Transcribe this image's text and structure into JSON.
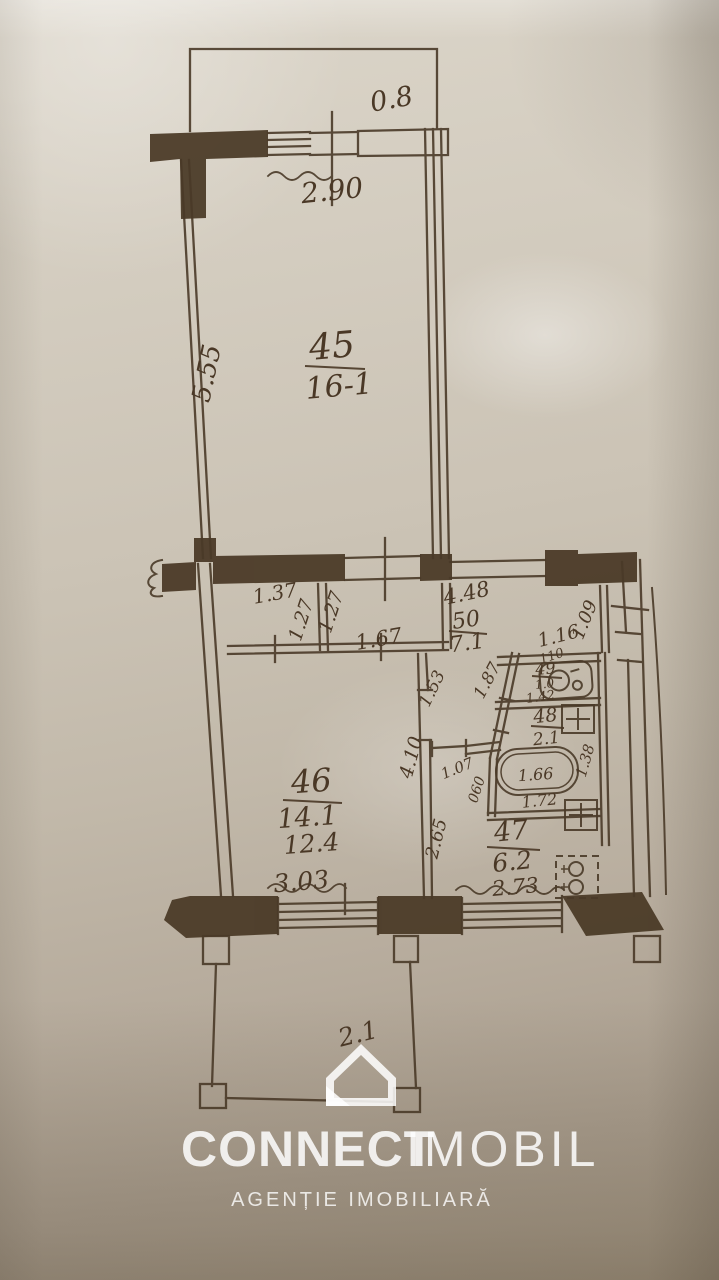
{
  "plan": {
    "rooms": {
      "r45": {
        "number": "45",
        "area": "16-1"
      },
      "r46": {
        "number": "46",
        "area": "14.1",
        "area_alt": "12.4"
      },
      "r47": {
        "number": "47",
        "area": "6.2"
      },
      "r48": {
        "number": "48",
        "area": "2.1"
      },
      "r49": {
        "number": "49",
        "area": "1.0"
      },
      "r50": {
        "number": "50",
        "area": "7.1"
      }
    },
    "dims": {
      "balcony_top_depth": "0.8",
      "window_top": "2.90",
      "room45_depth": "5.55",
      "closet_width": "1.37",
      "closet_depth_1": "1.27",
      "closet_depth_2": "1.27",
      "closet_width_2": "1.67",
      "hall_length": "4.48",
      "right_niche_1": "1.09",
      "right_niche_2": "1.16",
      "wc_width": "110",
      "wc_depth": "1.42",
      "diag_wall": "1.87",
      "niche_depth": "1.53",
      "room46_length": "4.10",
      "door_width": "1.07",
      "door_width_2": "060",
      "tub_length": "1.66",
      "bath_width": "1.38",
      "bath_length": "1.72",
      "hall2_length": "2.65",
      "window_room46": "3.03",
      "window_kitchen": "2.73",
      "balcony_bottom_depth": "2.1"
    }
  },
  "watermark": {
    "brand_bold": "CONNECT",
    "brand_light": "IMOBIL",
    "tagline": "AGENȚIE IMOBILIARĂ"
  },
  "colors": {
    "ink": "#4a3826",
    "paper": "#cbc3b5",
    "watermark": "#ffffff"
  }
}
